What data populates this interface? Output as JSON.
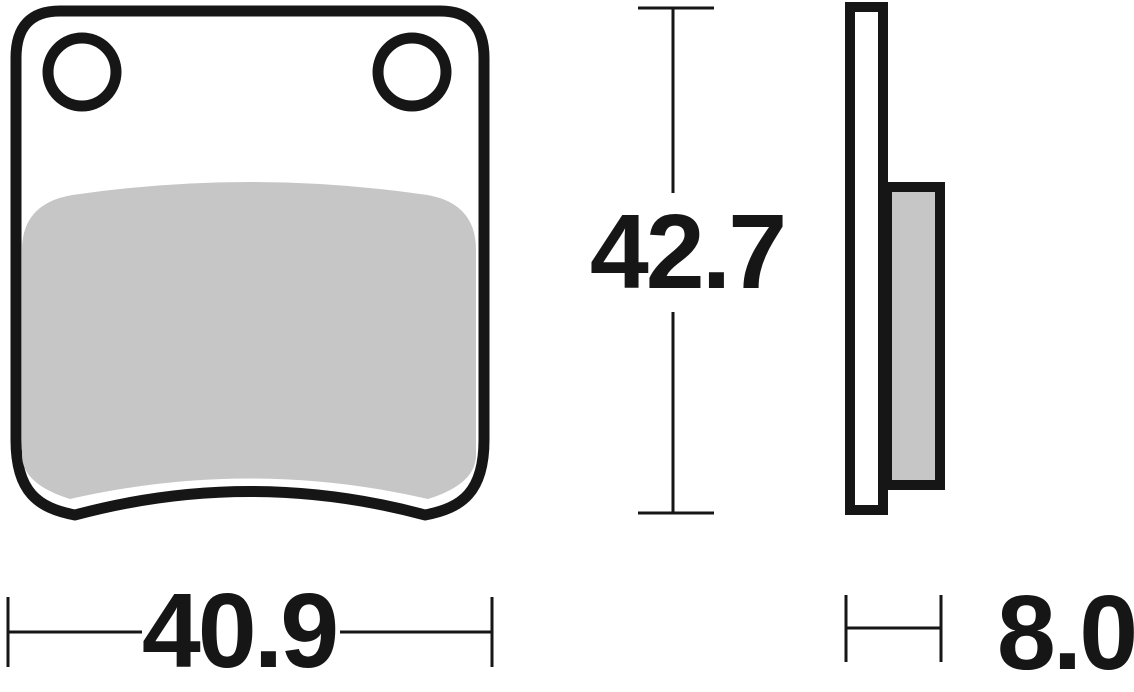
{
  "drawing": {
    "dimensions": {
      "width": {
        "label": "40.9"
      },
      "height": {
        "label": "42.7"
      },
      "thickness": {
        "label": "8.0"
      }
    },
    "colors": {
      "line": "#161616",
      "friction_material": "#c6c6c6",
      "backing_plate": "#ffffff",
      "background": "#ffffff"
    }
  }
}
